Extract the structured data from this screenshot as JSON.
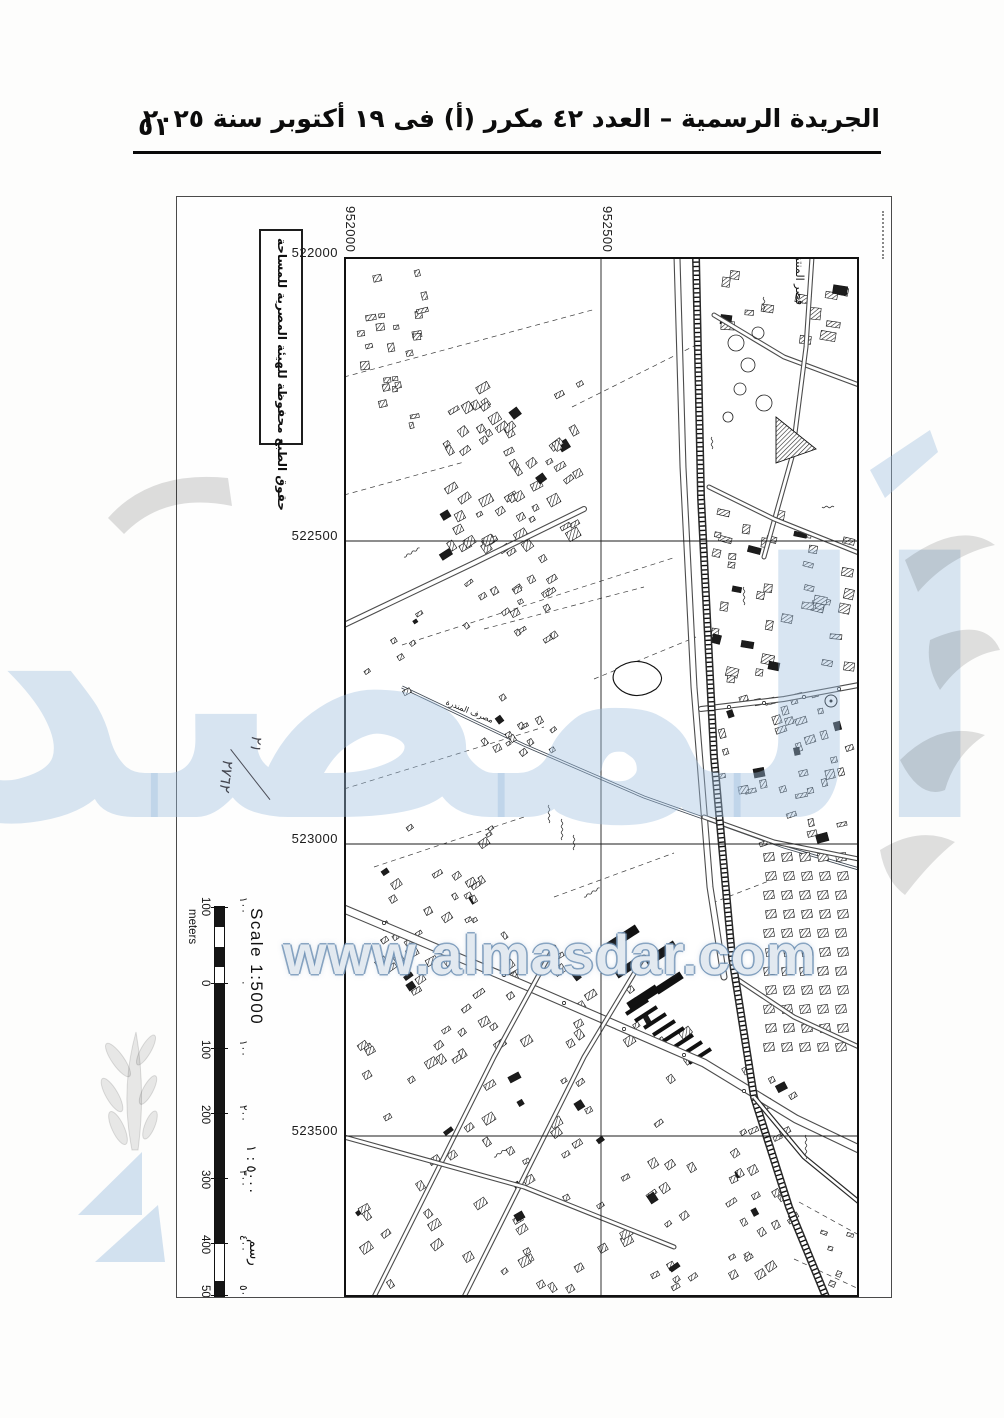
{
  "header": {
    "title": "الجريدة الرسمية – العدد ٤٢ مكرر (أ) فى ١٩ أكتوبر سنة ٢٠٢٥",
    "page_number": "٥١"
  },
  "watermark": {
    "url": "www.almasdar.com",
    "word": "المصدر"
  },
  "map": {
    "copyright": "حقوق الطبع محفوظة للهيئة المصرية للمساحة",
    "handwritten_note": {
      "numerator": "٢١",
      "denominator": "٢٧٦٢"
    },
    "grid": {
      "easting_labels": [
        "952000",
        "952500"
      ],
      "northing_labels": [
        "522000",
        "522500",
        "523000",
        "523500"
      ]
    },
    "scale": {
      "title_en": "Scale 1:5000",
      "unit_en": "meters",
      "ticks_en": [
        "100",
        "0",
        "100",
        "200",
        "300",
        "400",
        "500"
      ],
      "title_ar": "٥٠٠٠ : ١",
      "unit_ar": "رسم",
      "ticks_ar": [
        "١٠٠",
        "٠",
        "١٠٠",
        "٢٠٠",
        "٣٠٠",
        "٤٠٠",
        "٥٠٠"
      ]
    },
    "labels": {
      "palace": "قصر المنتزة",
      "drain": "مصرف المندرة"
    }
  }
}
